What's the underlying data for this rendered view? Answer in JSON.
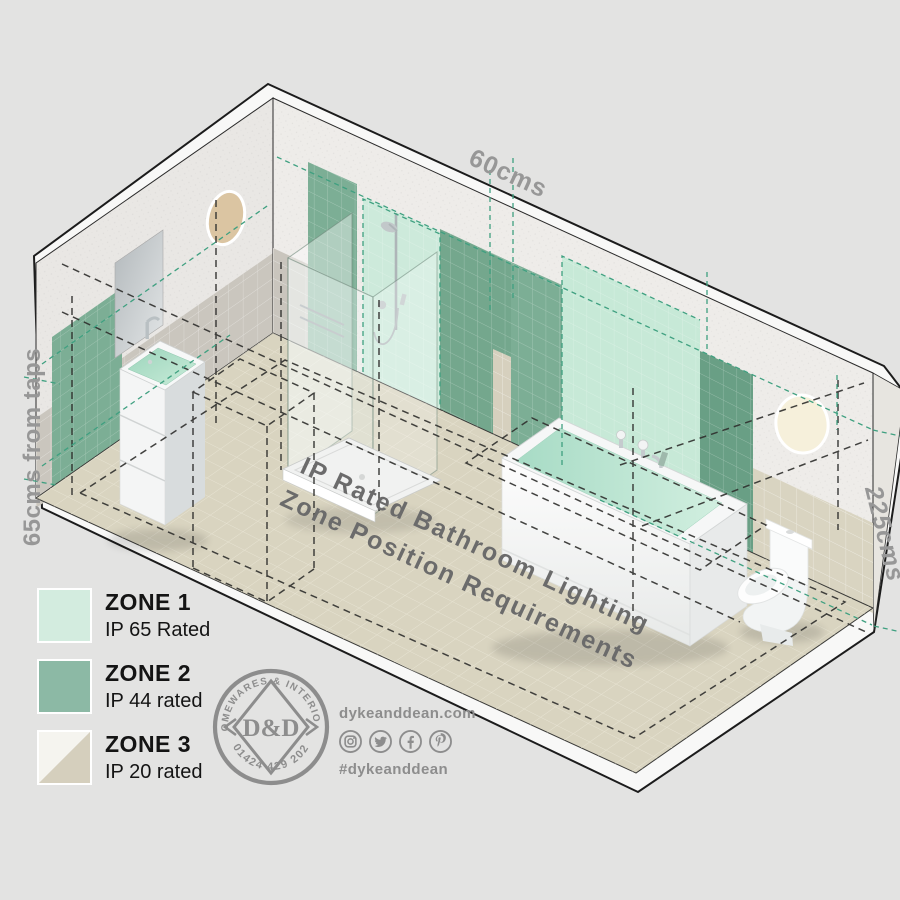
{
  "scene": {
    "dimensions": {
      "top": "60cms",
      "left": "65cms from taps",
      "right": "225cms"
    },
    "title_line1": "IP Rated Bathroom Lighting",
    "title_line2": "Zone Position Requirements"
  },
  "legend": {
    "zones": [
      {
        "name": "ZONE 1",
        "rating": "IP 65 Rated",
        "color": "#d3ecdf"
      },
      {
        "name": "ZONE 2",
        "rating": "IP 44 rated",
        "color": "#8cb9a5"
      },
      {
        "name": "ZONE 3",
        "rating": "IP 20 rated",
        "color_top": "#f5f4ef",
        "color_bottom": "#d5cfbd"
      }
    ]
  },
  "brand": {
    "arc_top": "HOMEWARES & INTERIORS",
    "monogram": "D&D",
    "phone": "01424 429 202",
    "website": "dykeanddean.com",
    "hashtag": "#dykeanddean",
    "social": [
      "instagram",
      "twitter",
      "facebook",
      "pinterest"
    ]
  },
  "palette": {
    "background": "#e3e3e2",
    "zone1_mint": "#cdeadb",
    "zone2_green": "#7cae95",
    "zone3_beige": "#d9d4c1",
    "floor": "#d9d4c0",
    "teal_dash": "#3fa080",
    "frame_white": "#f8f8f7",
    "dimension_text": "#979797",
    "title_text": "#6b6b6b"
  }
}
